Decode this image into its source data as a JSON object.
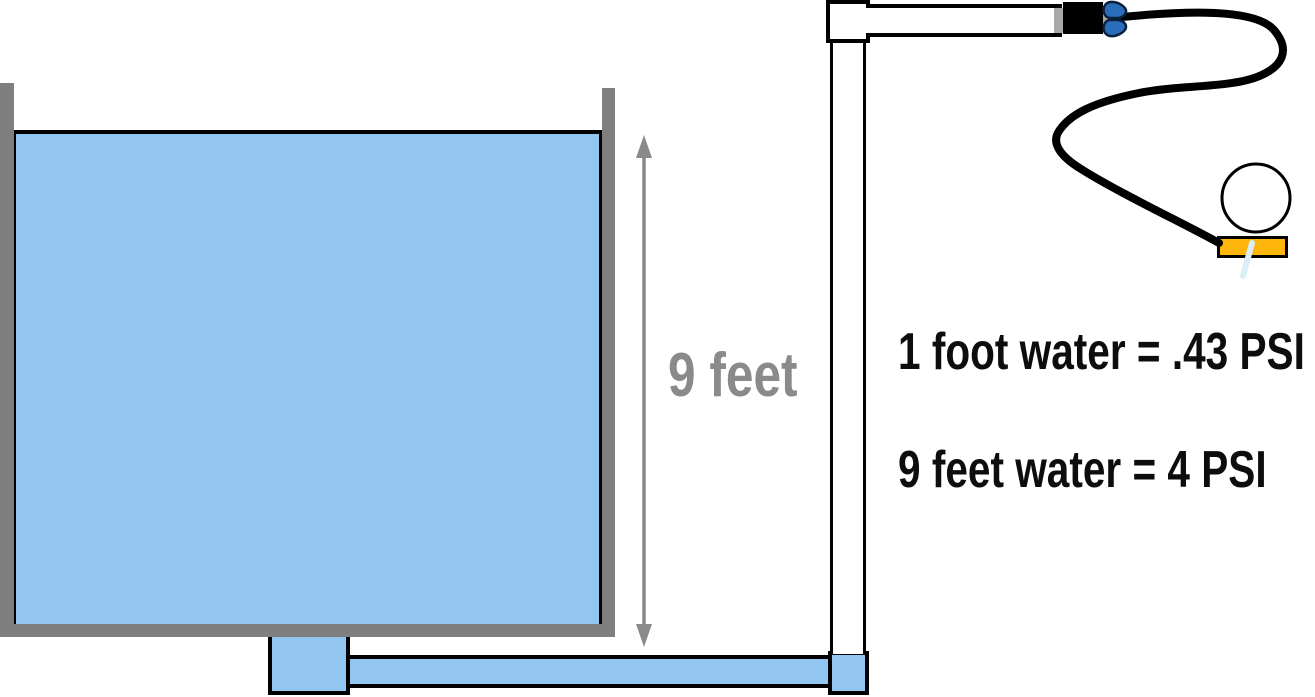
{
  "labels": {
    "tank_height": "9 feet",
    "conversion_line1": "1 foot water = .43 PSI",
    "conversion_line2": "9 feet water = 4 PSI"
  },
  "icons": {
    "valve_handle": "wing-nut-handle-icon",
    "gauge": "pressure-gauge-icon",
    "arrow": "double-headed-vertical-arrow"
  },
  "colors": {
    "background": "#ffffff",
    "water": "#92c5f0",
    "tank-wall": "#7f7f7f",
    "arrow": "#8a8a8a",
    "label-gray": "#8a8a8a",
    "text": "#0d0d0d",
    "valve-body": "#000000",
    "valve-collar": "#a8a8a8",
    "valve-handle": "#2a6ebb",
    "nozzle": "#feb60a",
    "water-drip": "#d9eef7"
  }
}
